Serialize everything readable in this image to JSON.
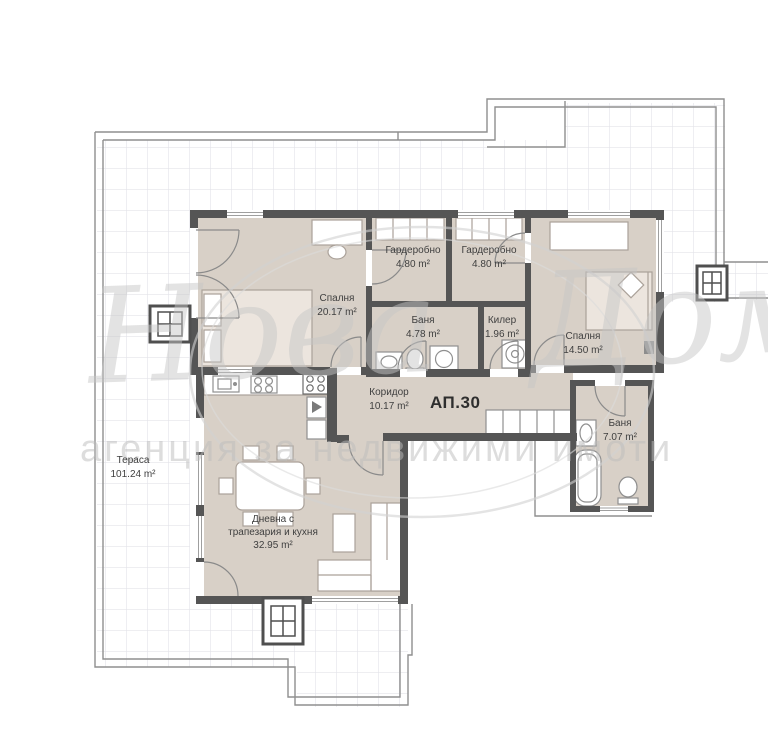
{
  "plan": {
    "apartment_label": "АП.30",
    "rooms": [
      {
        "id": "bedroom1",
        "name": "Спалня",
        "area": "20.17 m²"
      },
      {
        "id": "wardrobe1",
        "name": "Гардеробно",
        "area": "4.80 m²"
      },
      {
        "id": "wardrobe2",
        "name": "Гардеробно",
        "area": "4.80 m²"
      },
      {
        "id": "bath1",
        "name": "Баня",
        "area": "4.78 m²"
      },
      {
        "id": "storage",
        "name": "Килер",
        "area": "1.96 m²"
      },
      {
        "id": "bedroom2",
        "name": "Спалня",
        "area": "14.50 m²"
      },
      {
        "id": "corridor",
        "name": "Коридор",
        "area": "10.17 m²"
      },
      {
        "id": "bath2",
        "name": "Баня",
        "area": "7.07 m²"
      },
      {
        "id": "terrace",
        "name": "Тераса",
        "area": "101.24 m²"
      },
      {
        "id": "living",
        "name": "Дневна с трапезария и кухня",
        "area": "32.95 m²"
      }
    ],
    "watermark": {
      "logo": "Нова Дом",
      "subtitle": "агенция за недвижими имоти"
    },
    "colors": {
      "room_fill": "#d8d0c7",
      "wall": "#555555",
      "grid_line": "#e3e3e9",
      "outline": "#8f8f8f",
      "watermark": "#c6c6c6"
    }
  }
}
